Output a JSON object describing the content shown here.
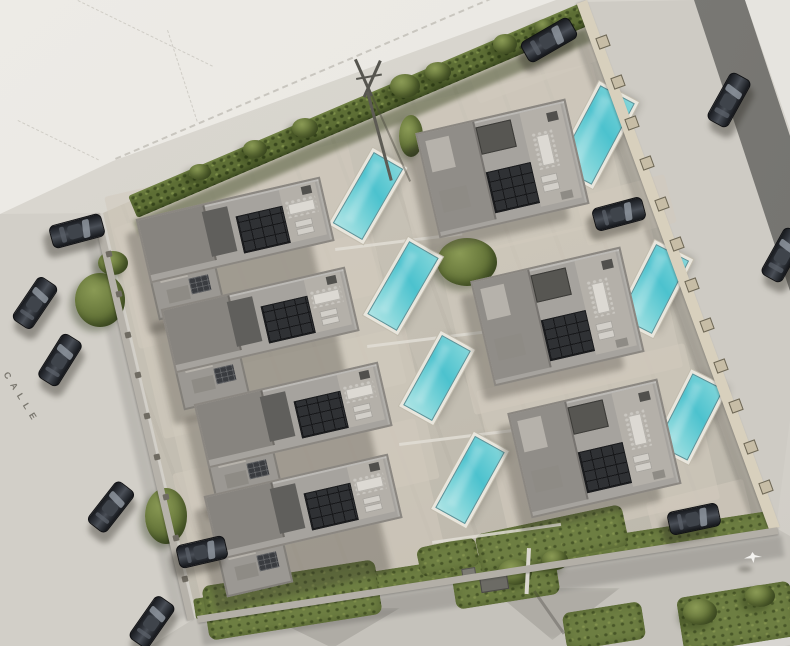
{
  "street_label": {
    "text": "CALLE"
  },
  "palette": {
    "ground": "#d6d3cc",
    "vacant_plot": "#ecebe6",
    "compound_paving": "#c5c0b4",
    "asphalt_road": "#7b7a76",
    "pool_water": "#4cc2ce",
    "pool_deck": "#e9e6dd",
    "roof_gray": "#a6a39e",
    "roof_dark": "#605f5c",
    "solar_panel": "#2f3134",
    "hedge_green": "#5d6e35",
    "grass_green": "#6d7e42",
    "wall_beige": "#d8d0bd",
    "wall_gray": "#b6b2aa",
    "car_charcoal": "#2d3036",
    "path_light": "#e0ddd5",
    "label_gray": "#75726a"
  },
  "compound": {
    "outline": [
      [
        584,
        2
      ],
      [
        776,
        528
      ],
      [
        197,
        617
      ],
      [
        103,
        213
      ]
    ]
  },
  "villas": [
    {
      "id": "villa-1",
      "type": "L",
      "x": 237,
      "y": 247,
      "rot": -13
    },
    {
      "id": "villa-2",
      "type": "L",
      "x": 262,
      "y": 337,
      "rot": -13
    },
    {
      "id": "villa-3",
      "type": "L",
      "x": 295,
      "y": 432,
      "rot": -13
    },
    {
      "id": "villa-4",
      "type": "L",
      "x": 305,
      "y": 524,
      "rot": -13
    },
    {
      "id": "villa-5",
      "type": "R",
      "x": 500,
      "y": 167,
      "rot": -13
    },
    {
      "id": "villa-6",
      "type": "R",
      "x": 555,
      "y": 315,
      "rot": -13
    },
    {
      "id": "villa-7",
      "type": "R",
      "x": 592,
      "y": 447,
      "rot": -13
    }
  ],
  "pools": [
    {
      "x": 368,
      "y": 196,
      "rot": -60,
      "w": 80,
      "h": 32
    },
    {
      "x": 403,
      "y": 286,
      "rot": -60,
      "w": 82,
      "h": 32
    },
    {
      "x": 437,
      "y": 378,
      "rot": -61,
      "w": 78,
      "h": 31
    },
    {
      "x": 470,
      "y": 480,
      "rot": -61,
      "w": 80,
      "h": 32
    },
    {
      "x": 596,
      "y": 135,
      "rot": -62,
      "w": 90,
      "h": 37
    },
    {
      "x": 654,
      "y": 289,
      "rot": -63,
      "w": 80,
      "h": 35
    },
    {
      "x": 690,
      "y": 417,
      "rot": -63,
      "w": 78,
      "h": 33
    }
  ],
  "cars": [
    {
      "x": 77,
      "y": 231,
      "rot": -15,
      "len": 54
    },
    {
      "x": 35,
      "y": 303,
      "rot": -56,
      "len": 52
    },
    {
      "x": 60,
      "y": 360,
      "rot": -58,
      "len": 52
    },
    {
      "x": 111,
      "y": 507,
      "rot": -52,
      "len": 52
    },
    {
      "x": 152,
      "y": 622,
      "rot": -55,
      "len": 52
    },
    {
      "x": 202,
      "y": 552,
      "rot": -13,
      "len": 50
    },
    {
      "x": 549,
      "y": 40,
      "rot": -30,
      "len": 56
    },
    {
      "x": 619,
      "y": 214,
      "rot": -15,
      "len": 52
    },
    {
      "x": 729,
      "y": 100,
      "rot": -61,
      "len": 54
    },
    {
      "x": 783,
      "y": 255,
      "rot": -61,
      "len": 54
    },
    {
      "x": 694,
      "y": 519,
      "rot": -12,
      "len": 52
    }
  ],
  "walls": [
    {
      "id": "wall-right",
      "x": 587,
      "y": 0,
      "len": 561,
      "rot": 69.9,
      "t": 11,
      "color": "#d8d0bd",
      "posts": 13,
      "postSize": 10,
      "postCls": "sq"
    },
    {
      "id": "wall-left",
      "x": 100,
      "y": 213,
      "len": 417,
      "rot": 76.9,
      "t": 7,
      "color": "#b6b2aa",
      "posts": 10,
      "postSize": 6,
      "postCls": "dot"
    },
    {
      "id": "wall-bottom",
      "x": 197,
      "y": 616,
      "len": 587,
      "rot": -8.7,
      "t": 7,
      "color": "#b3afa7",
      "posts": 0,
      "postSize": 0,
      "postCls": "dot"
    }
  ],
  "hedge": {
    "x": 128,
    "y": 196,
    "len": 497,
    "rot": -23.1,
    "t": 24
  },
  "grass_band": {
    "x": 193,
    "y": 599,
    "len": 585,
    "rot": -8.7,
    "t": 21
  },
  "shadows": [
    {
      "x": 133,
      "y": 221,
      "len": 492,
      "rot": -23.1,
      "t": 15,
      "color": "#39441f",
      "op": 0.45
    },
    {
      "x": 577,
      "y": 8,
      "len": 556,
      "rot": 69.9,
      "t": 13,
      "color": "#000000",
      "op": 0.14
    },
    {
      "x": 94,
      "y": 218,
      "len": 410,
      "rot": 76.9,
      "t": 14,
      "color": "#000000",
      "op": 0.1
    },
    {
      "x": 200,
      "y": 624,
      "len": 588,
      "rot": -8.7,
      "t": 22,
      "color": "#000000",
      "op": 0.14
    }
  ],
  "paths": [
    {
      "x": 335,
      "y": 248,
      "len": 128,
      "rot": -7
    },
    {
      "x": 367,
      "y": 345,
      "len": 130,
      "rot": -7
    },
    {
      "x": 399,
      "y": 443,
      "len": 132,
      "rot": -7
    },
    {
      "x": 432,
      "y": 541,
      "len": 130,
      "rot": -8
    },
    {
      "x": 556,
      "y": 150,
      "len": 56,
      "rot": -7
    },
    {
      "x": 604,
      "y": 300,
      "len": 60,
      "rot": -7
    },
    {
      "x": 640,
      "y": 430,
      "len": 60,
      "rot": -7
    }
  ],
  "pads": [
    {
      "x": 150,
      "y": 262,
      "rot": 70,
      "w": 88,
      "h": 46
    },
    {
      "x": 183,
      "y": 357,
      "rot": 70,
      "w": 88,
      "h": 46
    },
    {
      "x": 216,
      "y": 452,
      "rot": 70,
      "w": 88,
      "h": 46
    },
    {
      "x": 237,
      "y": 549,
      "rot": 70,
      "w": 88,
      "h": 46
    },
    {
      "x": 532,
      "y": 58,
      "rot": -20,
      "w": 130,
      "h": 50
    },
    {
      "x": 626,
      "y": 210,
      "rot": -15,
      "w": 92,
      "h": 50
    },
    {
      "x": 700,
      "y": 514,
      "rot": -14,
      "w": 100,
      "h": 48
    }
  ],
  "bushes": [
    {
      "x": 100,
      "y": 300,
      "w": 50,
      "h": 54
    },
    {
      "x": 113,
      "y": 263,
      "w": 30,
      "h": 24
    },
    {
      "x": 166,
      "y": 516,
      "w": 42,
      "h": 56
    },
    {
      "x": 467,
      "y": 262,
      "w": 60,
      "h": 48
    },
    {
      "x": 411,
      "y": 136,
      "w": 24,
      "h": 42
    },
    {
      "x": 405,
      "y": 86,
      "w": 30,
      "h": 24
    },
    {
      "x": 438,
      "y": 72,
      "w": 26,
      "h": 20
    },
    {
      "x": 505,
      "y": 44,
      "w": 24,
      "h": 20
    },
    {
      "x": 545,
      "y": 27,
      "w": 20,
      "h": 16
    },
    {
      "x": 305,
      "y": 128,
      "w": 26,
      "h": 20
    },
    {
      "x": 255,
      "y": 149,
      "w": 24,
      "h": 18
    },
    {
      "x": 200,
      "y": 172,
      "w": 22,
      "h": 16
    },
    {
      "x": 515,
      "y": 572,
      "w": 34,
      "h": 26
    },
    {
      "x": 555,
      "y": 560,
      "w": 26,
      "h": 20
    },
    {
      "x": 700,
      "y": 612,
      "w": 34,
      "h": 26
    },
    {
      "x": 760,
      "y": 596,
      "w": 30,
      "h": 22
    }
  ],
  "grass_patches": [
    {
      "x": 292,
      "y": 600,
      "rot": -9,
      "w": 175,
      "h": 55
    },
    {
      "x": 505,
      "y": 578,
      "rot": -9,
      "w": 105,
      "h": 48
    },
    {
      "x": 552,
      "y": 540,
      "rot": -12,
      "w": 150,
      "h": 42
    },
    {
      "x": 737,
      "y": 617,
      "rot": -9,
      "w": 115,
      "h": 56
    },
    {
      "x": 604,
      "y": 626,
      "rot": -9,
      "w": 80,
      "h": 38
    },
    {
      "x": 448,
      "y": 557,
      "rot": -12,
      "w": 60,
      "h": 30
    }
  ],
  "bird": {
    "x": 744,
    "y": 552
  }
}
